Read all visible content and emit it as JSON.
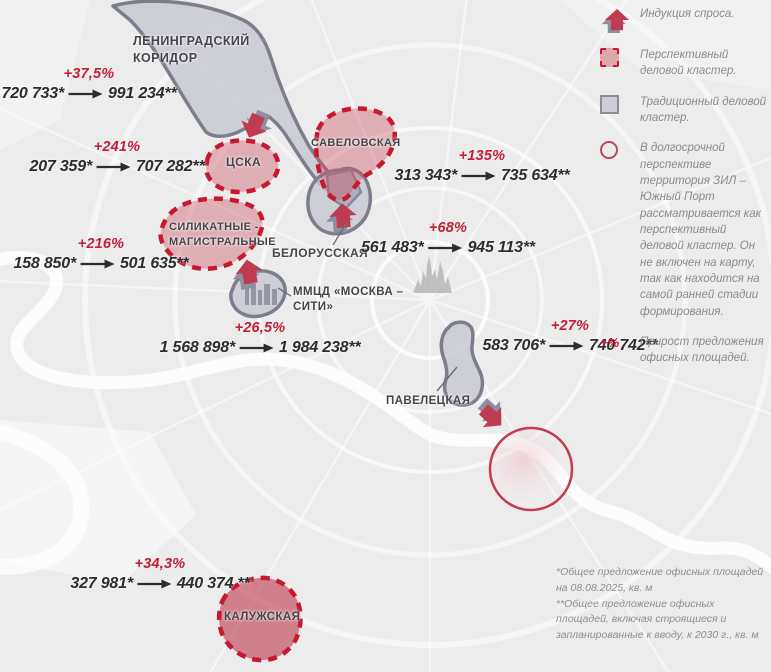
{
  "map_title": "Москва — деловые кластеры, офисные площади",
  "clusters": {
    "leningradsky": {
      "label": "ЛЕНИНГРАДСКИЙ КОРИДОР",
      "type": "traditional"
    },
    "cska": {
      "label": "ЦСКА",
      "type": "perspective"
    },
    "savelovskaya": {
      "label": "САВЕЛОВСКАЯ",
      "type": "perspective"
    },
    "silikatnye": {
      "label": "СИЛИКАТНЫЕ - МАГИСТРАЛЬНЫЕ",
      "type": "perspective"
    },
    "belorusskaya": {
      "label": "БЕЛОРУССКАЯ",
      "type": "traditional"
    },
    "moscow_city": {
      "label": "ММЦД «МОСКВА – СИТИ»",
      "type": "traditional"
    },
    "paveletskaya": {
      "label": "ПАВЕЛЕЦКАЯ",
      "type": "traditional"
    },
    "kaluzhskaya": {
      "label": "КАЛУЖСКАЯ",
      "type": "perspective"
    }
  },
  "stats": [
    {
      "cluster": "leningradsky-corridor",
      "percent": "+37,5%",
      "from": "720 733*",
      "to": "991 234**"
    },
    {
      "cluster": "cska",
      "percent": "+241%",
      "from": "207 359*",
      "to": "707 282**"
    },
    {
      "cluster": "savelovskaya",
      "percent": "+135%",
      "from": "313 343*",
      "to": "735 634**"
    },
    {
      "cluster": "silikatnye-magistralnye",
      "percent": "+216%",
      "from": "158 850*",
      "to": "501 635**"
    },
    {
      "cluster": "belorusskaya",
      "percent": "+68%",
      "from": "561 483*",
      "to": "945 113**"
    },
    {
      "cluster": "moscow-city",
      "percent": "+26,5%",
      "from": "1 568 898*",
      "to": "1 984 238**"
    },
    {
      "cluster": "paveletskaya",
      "percent": "+27%",
      "from": "583 706*",
      "to": "740 742**"
    },
    {
      "cluster": "kaluzhskaya",
      "percent": "+34,3%",
      "from": "327 981*",
      "to": "440 374 **"
    }
  ],
  "legend": {
    "items": [
      {
        "icon": "demand-arrow-icon",
        "label": "Индукция спроса."
      },
      {
        "icon": "dashed-square-icon",
        "label": "Перспективный деловой кластер."
      },
      {
        "icon": "gray-square-icon",
        "label": "Традиционный деловой кластер."
      },
      {
        "icon": "circle-outline-icon",
        "label": "В долгосрочной перспективе территория ЗИЛ – Южный Порт рассматривается как перспективный деловой кластер. Он не включен на карту, так как находится на самой ранней стадии формирования."
      },
      {
        "icon": "plus-percent-icon",
        "symbol": "+%",
        "label": "Прирост предложения офисных площадей."
      }
    ]
  },
  "footnotes": {
    "line1": "*Общее предложение офисных площадей на 08.08.2025, кв. м",
    "line2": "**Общее предложение офисных площадей, включая строящиеся и запланированные к вводу, к 2030 г., кв. м"
  },
  "colors": {
    "accent_red": "#c6182f",
    "percent_red": "#c32038",
    "traditional_border": "#7c7e8c",
    "traditional_fill": "#c6c7d1",
    "perspective_fill": "#e2a9b1",
    "map_background": "#ececec"
  }
}
